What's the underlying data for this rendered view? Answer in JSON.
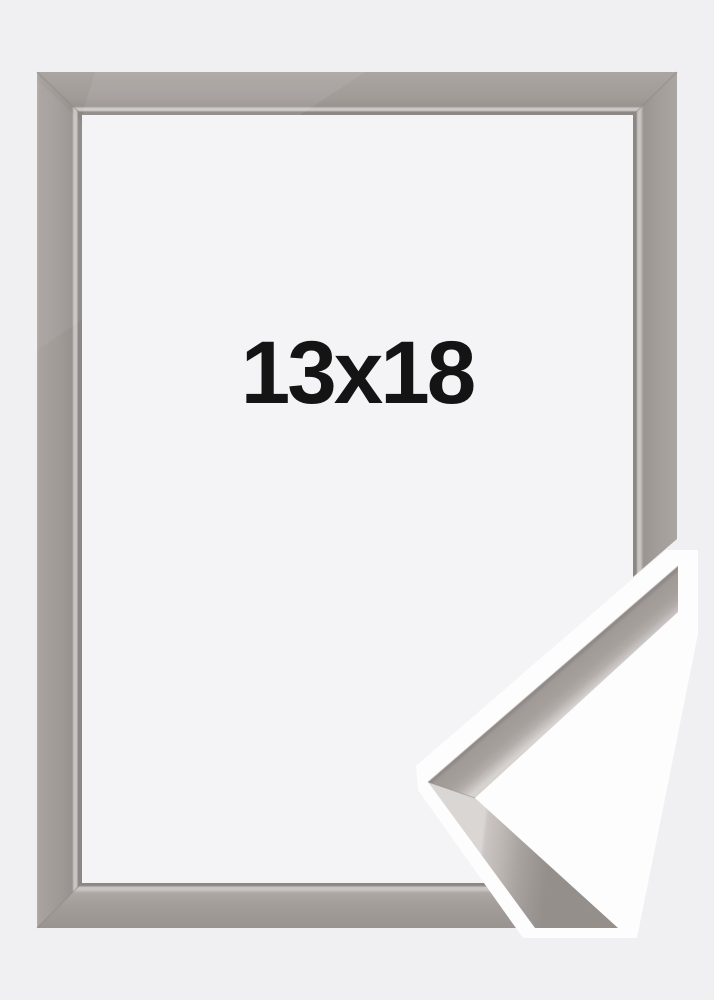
{
  "product_image": {
    "size_label": "13x18",
    "colors": {
      "background": "#f0eff1",
      "interior": "#f4f4f6",
      "halo": "#fdfdfd",
      "frame_face": "#a19b98",
      "frame_highlight": "#cbc7c5",
      "frame_shadow": "#8c8784",
      "label_text": "#141414"
    }
  }
}
